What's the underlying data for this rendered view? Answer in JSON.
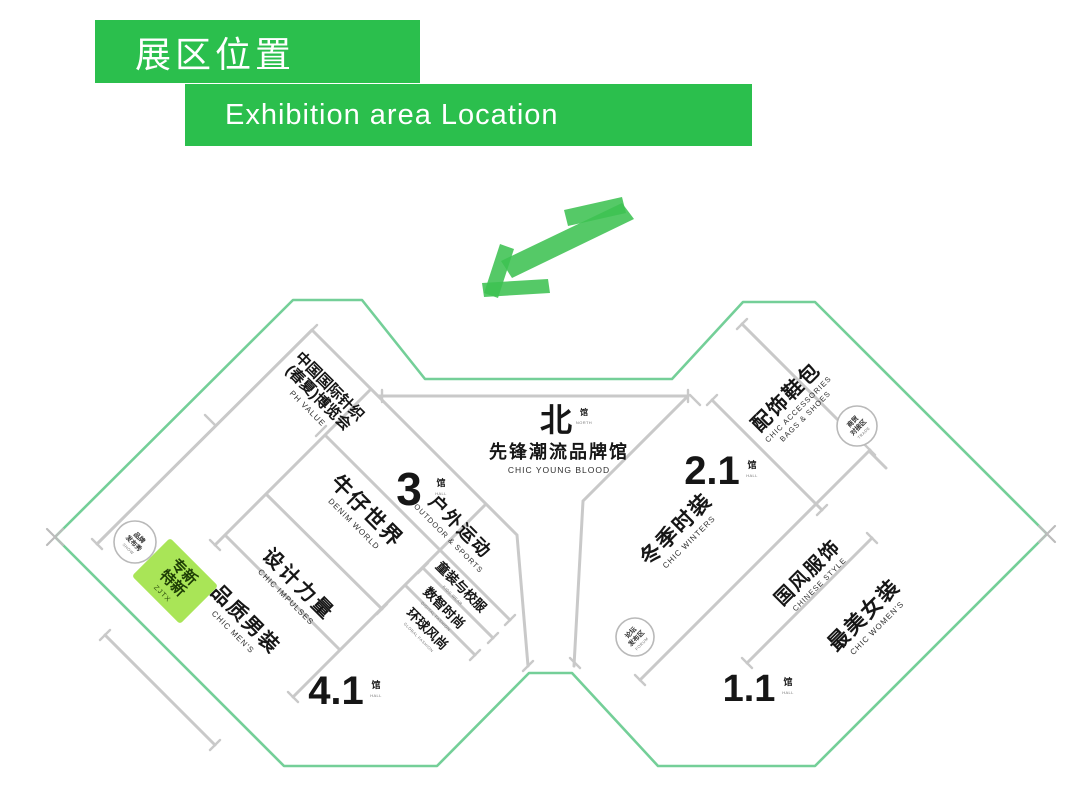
{
  "header": {
    "title_zh": "展区位置",
    "title_en": "Exhibition area Location"
  },
  "colors": {
    "header_green": "#2bbf4d",
    "arrow_green": "#3ec152",
    "outline_green": "#74cf98",
    "highlight_green": "#a9e557",
    "divider_gray": "#c9c9c9"
  },
  "north_hall": {
    "big": "北",
    "suffix": "馆",
    "suffix_en": "NORTH",
    "title": "先锋潮流品牌馆",
    "subtitle": "CHIC YOUNG BLOOD"
  },
  "hall_numbers": {
    "h3": {
      "num": "3",
      "suffix": "馆",
      "suffix_en": "HALL"
    },
    "h41": {
      "num": "4.1",
      "suffix": "馆",
      "suffix_en": "HALL"
    },
    "h21": {
      "num": "2.1",
      "suffix": "馆",
      "suffix_en": "HALL"
    },
    "h11": {
      "num": "1.1",
      "suffix": "馆",
      "suffix_en": "HALL"
    }
  },
  "zones": {
    "ph": {
      "line1": "中国国际针织",
      "line2": "(春夏)博览会",
      "en": "PH VALUE"
    },
    "denim": {
      "zh": "牛仔世界",
      "en": "DENIM WORLD"
    },
    "outdoor": {
      "zh": "户外运动",
      "en": "OUTDOOR & SPORTS"
    },
    "kids": {
      "zh": "童装与校服",
      "en": "KIDS WEAR"
    },
    "digital": {
      "zh": "数智时尚",
      "en": "DIGITAL FASHION"
    },
    "global": {
      "zh": "环球风尚",
      "en": "GLOBAL FASHION"
    },
    "impulses": {
      "zh": "设计力量",
      "en": "CHIC IMPULSES"
    },
    "mens": {
      "zh": "品质男装",
      "en": "CHIC MEN'S"
    },
    "zjtx": {
      "line1": "专新",
      "line2": "特新",
      "en": "ZJTX"
    },
    "accessories": {
      "zh": "配饰鞋包",
      "en1": "CHIC ACCESSORIES",
      "en2": "BAGS & SHOES"
    },
    "winters": {
      "zh": "冬季时装",
      "en": "CHIC WINTERS"
    },
    "chinese": {
      "zh": "国风服饰",
      "en": "CHINESE STYLE"
    },
    "womens": {
      "zh": "最美女装",
      "en": "CHIC WOMEN'S"
    }
  },
  "badges": {
    "brand_show": {
      "line1": "品牌",
      "line2": "发布秀",
      "sub": "SHOW"
    },
    "trade": {
      "line1": "商贸",
      "line2": "对接区",
      "sub": "TRADE"
    },
    "forum": {
      "line1": "论坛",
      "line2": "发布区",
      "sub": "FORUM"
    }
  }
}
